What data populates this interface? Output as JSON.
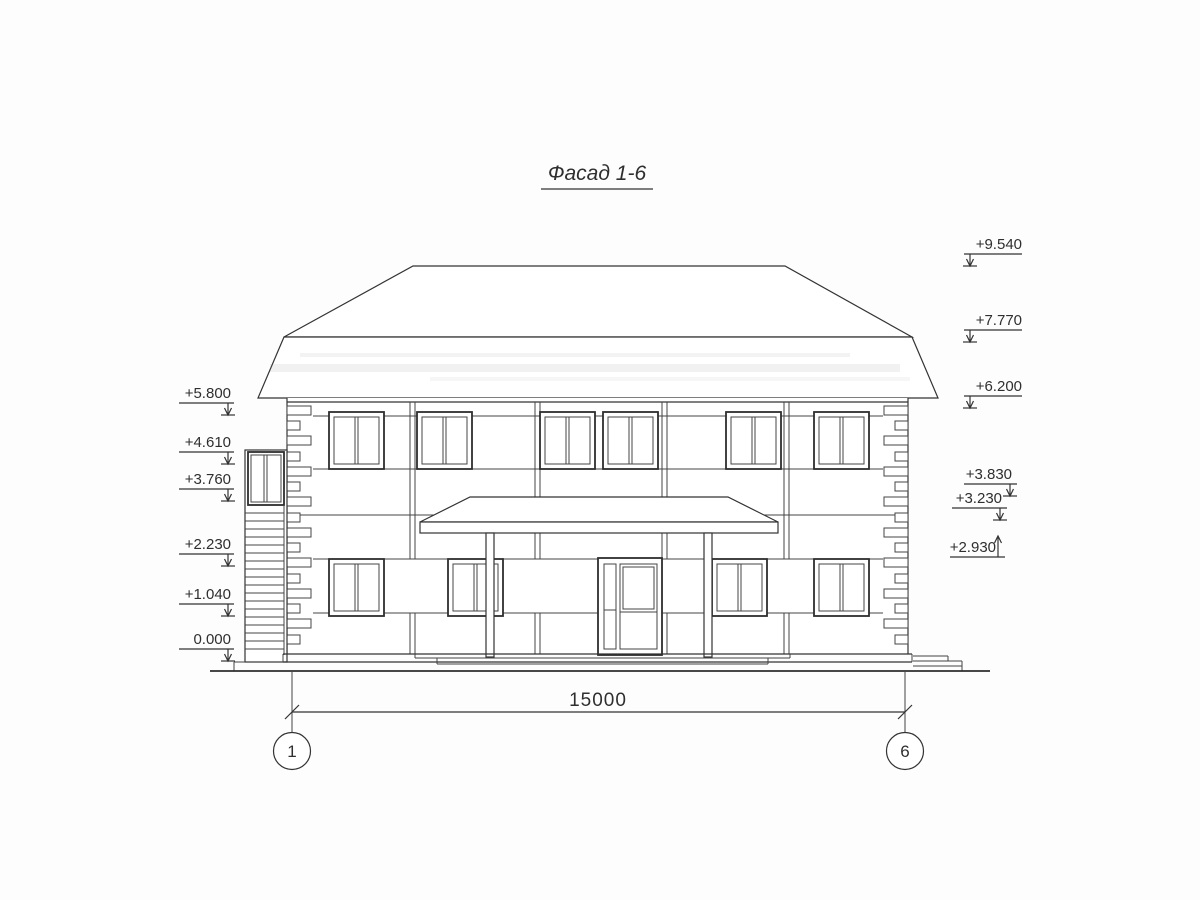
{
  "title": "Фасад 1-6",
  "marks_left": [
    {
      "value": "+5.800"
    },
    {
      "value": "+4.610"
    },
    {
      "value": "+3.760"
    },
    {
      "value": "+2.230"
    },
    {
      "value": "+1.040"
    },
    {
      "value": "0.000"
    }
  ],
  "marks_right": [
    {
      "value": "+9.540"
    },
    {
      "value": "+7.770"
    },
    {
      "value": "+6.200"
    },
    {
      "value": "+3.830"
    },
    {
      "value": "+3.230"
    },
    {
      "value": "+2.930"
    }
  ],
  "dimension": {
    "value": "15000"
  },
  "axes": [
    {
      "value": "1"
    },
    {
      "value": "6"
    }
  ],
  "colors": {
    "line": "#333333",
    "paper": "#ffffff"
  }
}
